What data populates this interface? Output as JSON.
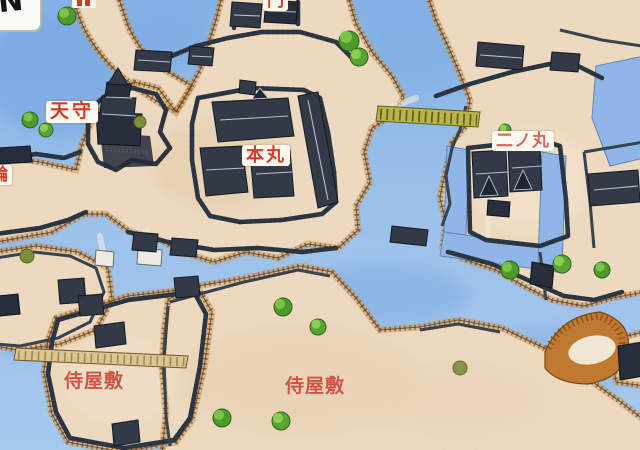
{
  "compass": {
    "label": "N"
  },
  "labels": {
    "tenshu": {
      "text": "天守"
    },
    "honmaru": {
      "text": "本丸"
    },
    "ninomaru": {
      "text": "二ノ丸"
    },
    "samurai_left": {
      "text": "侍屋敷"
    },
    "samurai_right": {
      "text": "侍屋敷"
    },
    "gate_clipped": {
      "text": "門"
    },
    "kuruwa_clipped": {
      "text": "輪"
    }
  },
  "palette": {
    "water": "#9cc1ea",
    "water_deep": "#7aa9e0",
    "land": "#ecd9bf",
    "shore_brown": "#7a4c1e",
    "wall_dark": "#2d3542",
    "roof": "#323a48",
    "tree_green": "#4e9a2c",
    "bridge_yellow": "#b9b54a",
    "slope_orange": "#c07a30",
    "label_red": "#d23b2c",
    "label_bg": "#fdf9ee"
  }
}
